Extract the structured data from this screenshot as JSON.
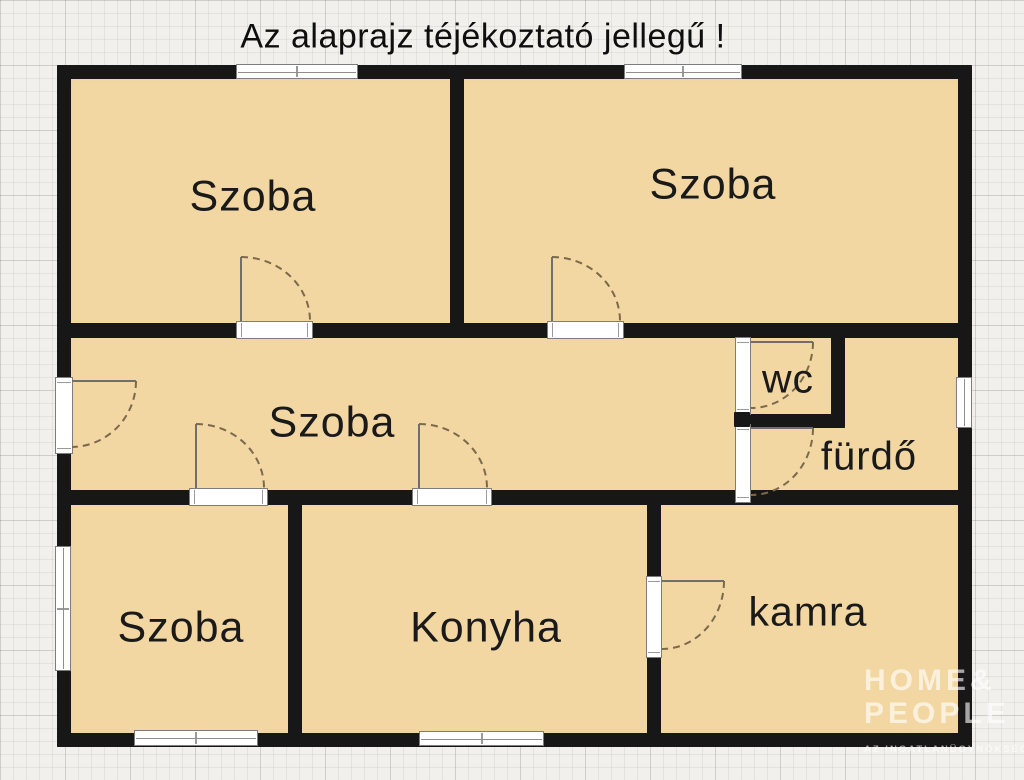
{
  "title": "Az alaprajz téjékoztató jellegű !",
  "rooms": {
    "szoba_top_left": "Szoba",
    "szoba_top_right": "Szoba",
    "szoba_hall": "Szoba",
    "szoba_bottom_left": "Szoba",
    "konyha": "Konyha",
    "kamra": "kamra",
    "wc": "wc",
    "furdo": "fürdő"
  },
  "watermark": {
    "line1": "HOME&",
    "line2": "PEOPLE",
    "tagline": "AZ INGATLANÜGYNÖKSÉG"
  },
  "colors": {
    "wall": "#171717",
    "floor": "#f3d7a3",
    "background": "#f1f0ec",
    "door_arc": "#7b6a4a",
    "door_leaf": "#6f6f6f",
    "frame_border": "#7d7d7d",
    "label": "#1a1a1a",
    "watermark": "rgba(255,255,255,0.62)"
  }
}
